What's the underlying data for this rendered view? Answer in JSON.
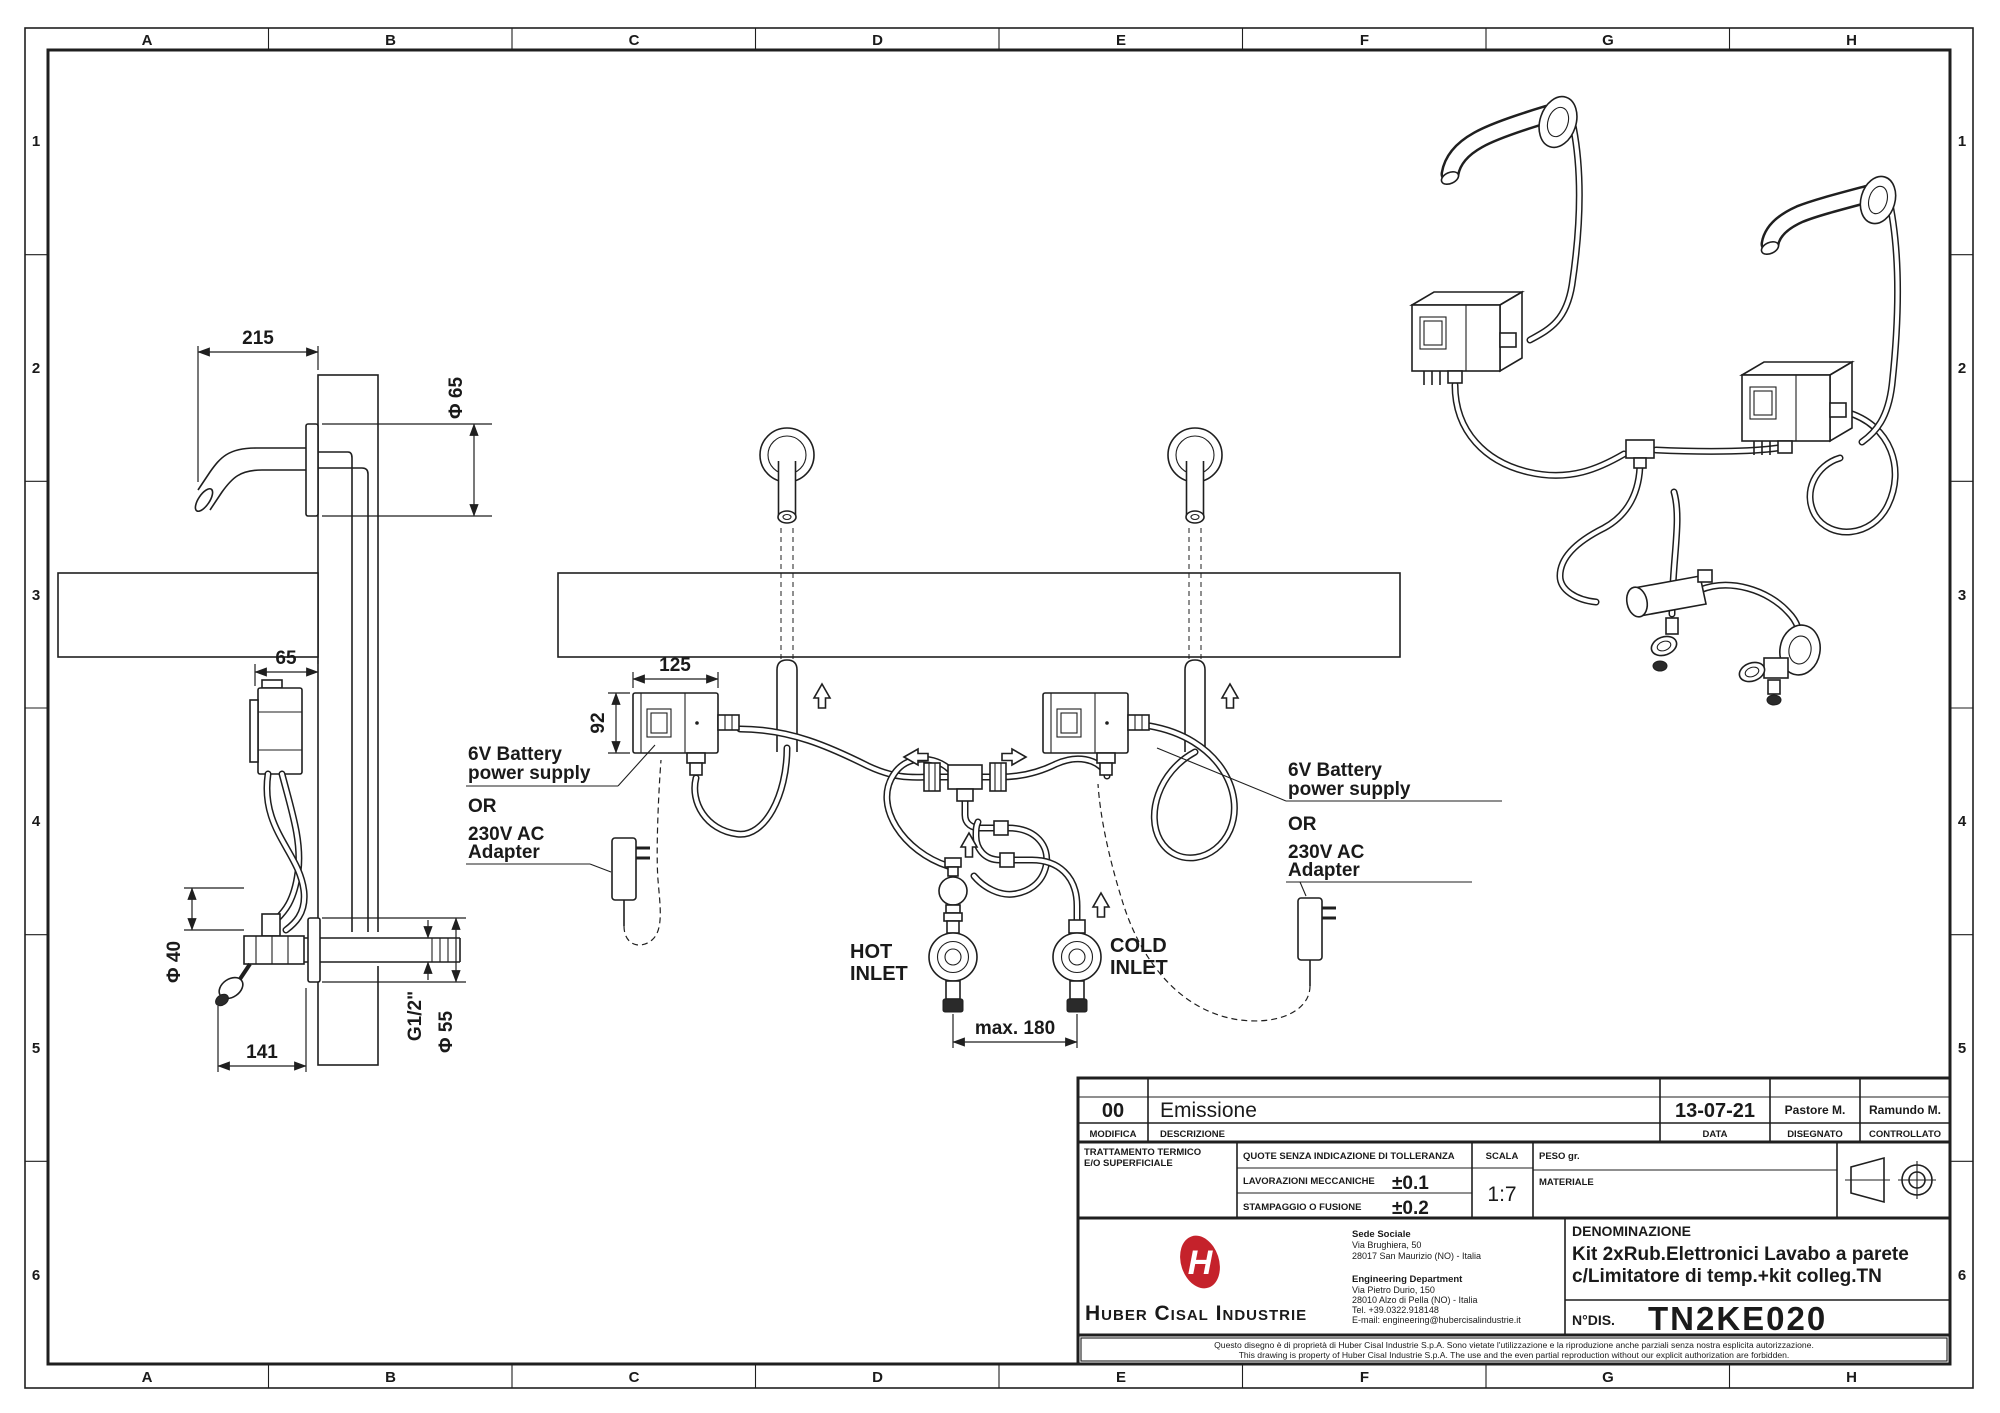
{
  "grid": {
    "columns": [
      "A",
      "B",
      "C",
      "D",
      "E",
      "F",
      "G",
      "H"
    ],
    "rows": [
      "1",
      "2",
      "3",
      "4",
      "5",
      "6"
    ]
  },
  "side_view": {
    "dim_215": "215",
    "dim_phi65": "Φ 65",
    "dim_65": "65",
    "dim_phi40": "Φ 40",
    "dim_141": "141",
    "dim_g12": "G1/2\"",
    "dim_phi55": "Φ 55"
  },
  "front_view": {
    "dim_125": "125",
    "dim_92": "92",
    "dim_max180": "max. 180",
    "hot_1": "HOT",
    "hot_2": "INLET",
    "cold_1": "COLD",
    "cold_2": "INLET"
  },
  "power": {
    "battery_1": "6V Battery",
    "battery_2": "power supply",
    "or": "OR",
    "adapter_1": "230V AC",
    "adapter_2": "Adapter"
  },
  "title_block": {
    "revision": {
      "rev": "00",
      "description": "Emissione",
      "date": "13-07-21",
      "drawn": "Pastore M.",
      "checked": "Ramundo M.",
      "label_modifica": "MODIFICA",
      "label_descrizione": "DESCRIZIONE",
      "label_data": "DATA",
      "label_disegnato": "DISEGNATO",
      "label_controllato": "CONTROLLATO"
    },
    "treatment_line1": "TRATTAMENTO TERMICO",
    "treatment_line2": "E/O SUPERFICIALE",
    "tol_header": "QUOTE SENZA INDICAZIONE DI TOLLERANZA",
    "tol_mech_label": "LAVORAZIONI MECCANICHE",
    "tol_mech_value": "±0.1",
    "tol_cast_label": "STAMPAGGIO O FUSIONE",
    "tol_cast_value": "±0.2",
    "scala_label": "SCALA",
    "scala_value": "1:7",
    "peso_label": "PESO gr.",
    "materiale_label": "MATERIALE",
    "logo_letter": "H",
    "company_name": "Huber Cisal Industrie",
    "hq_title": "Sede Sociale",
    "hq_addr1": "Via Brughiera, 50",
    "hq_addr2": "28017 San Maurizio (NO) - Italia",
    "eng_title": "Engineering Department",
    "eng_addr1": "Via Pietro Durio, 150",
    "eng_addr2": "28010 Alzo di Pella (NO) - Italia",
    "eng_tel": "Tel. +39.0322.918148",
    "eng_email": "E-mail: engineering@hubercisalindustrie.it",
    "denominazione_label": "DENOMINAZIONE",
    "denominazione_line1": "Kit 2xRub.Elettronici Lavabo a parete",
    "denominazione_line2": "c/Limitatore di temp.+kit colleg.TN",
    "ndis_label": "N°DIS.",
    "drawing_number": "TN2KE020",
    "disclaimer_it": "Questo disegno è di proprietà di Huber Cisal Industrie S.p.A. Sono vietate l'utilizzazione e la riproduzione anche parziali senza nostra esplicita autorizzazione.",
    "disclaimer_en": "This drawing is property of Huber Cisal Industrie S.p.A. The use and the even partial reproduction without our explicit authorization are forbidden."
  },
  "colors": {
    "line": "#1f1f1f",
    "logo_red": "#c5222b"
  }
}
